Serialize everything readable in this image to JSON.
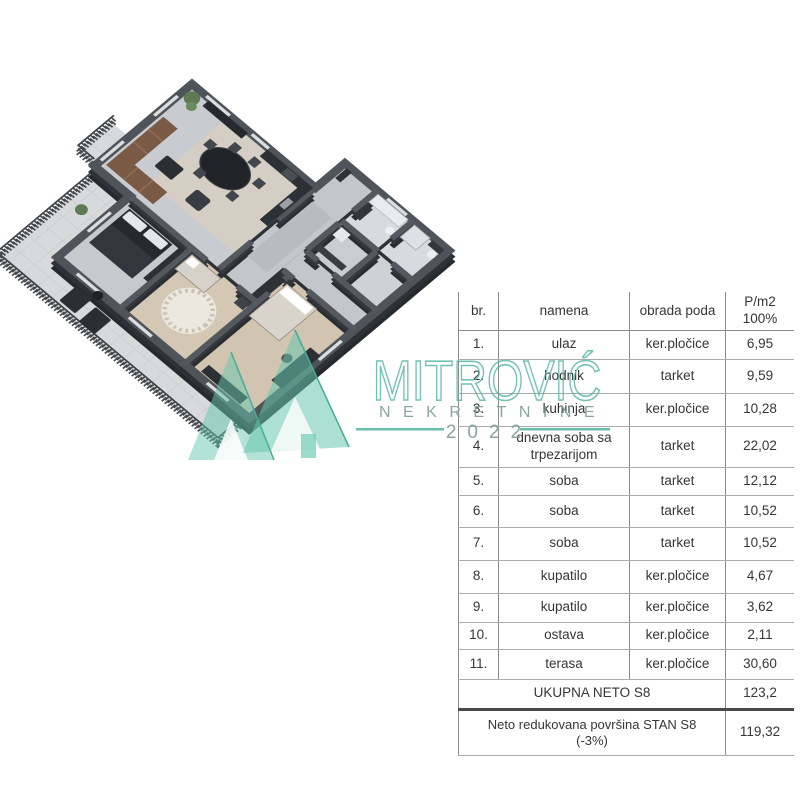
{
  "watermark": {
    "brand": "MITROVIĆ",
    "subtitle": "NEKRETNINE",
    "year": "2022",
    "accent": "#4fb2a0"
  },
  "table": {
    "header": {
      "col1": "br.",
      "col2": "namena",
      "col3": "obrada poda",
      "col4_line1": "P/m2",
      "col4_line2": "100%"
    },
    "rows": [
      {
        "no": "1.",
        "namena": "ulaz",
        "obrada": "ker.pločice",
        "pm2": "6,95"
      },
      {
        "no": "2.",
        "namena": "hodnik",
        "obrada": "tarket",
        "pm2": "9,59"
      },
      {
        "no": "3.",
        "namena": "kuhinja",
        "obrada": "ker.pločice",
        "pm2": "10,28"
      },
      {
        "no": "4.",
        "namena": "dnevna soba sa trpezarijom",
        "obrada": "tarket",
        "pm2": "22,02"
      },
      {
        "no": "5.",
        "namena": "soba",
        "obrada": "tarket",
        "pm2": "12,12"
      },
      {
        "no": "6.",
        "namena": "soba",
        "obrada": "tarket",
        "pm2": "10,52"
      },
      {
        "no": "7.",
        "namena": "soba",
        "obrada": "tarket",
        "pm2": "10,52"
      },
      {
        "no": "8.",
        "namena": "kupatilo",
        "obrada": "ker.pločice",
        "pm2": "4,67"
      },
      {
        "no": "9.",
        "namena": "kupatilo",
        "obrada": "ker.pločice",
        "pm2": "3,62"
      },
      {
        "no": "10.",
        "namena": "ostava",
        "obrada": "ker.pločice",
        "pm2": "2,11"
      },
      {
        "no": "11.",
        "namena": "terasa",
        "obrada": "ker.pločice",
        "pm2": "30,60"
      }
    ],
    "total": {
      "label": "UKUPNA NETO S8",
      "value": "123,2"
    },
    "reduced": {
      "label_line1": "Neto redukovana površina STAN S8",
      "label_line2": "(-3%)",
      "value": "119,32"
    }
  },
  "floorplan": {
    "colors": {
      "wall_dark": "#26292d",
      "wall_top": "#51565c",
      "floor_gray": "#c8cbcf",
      "floor_dining": "#d7cec0",
      "floor_wood": "#d4c7b4",
      "floor_bath": "#d8dbde",
      "terrace": "#d7d9da",
      "sofa": "#7a5a44",
      "bed_dark": "#26292d",
      "plant": "#5d7a52",
      "counter": "#2d3135"
    }
  }
}
